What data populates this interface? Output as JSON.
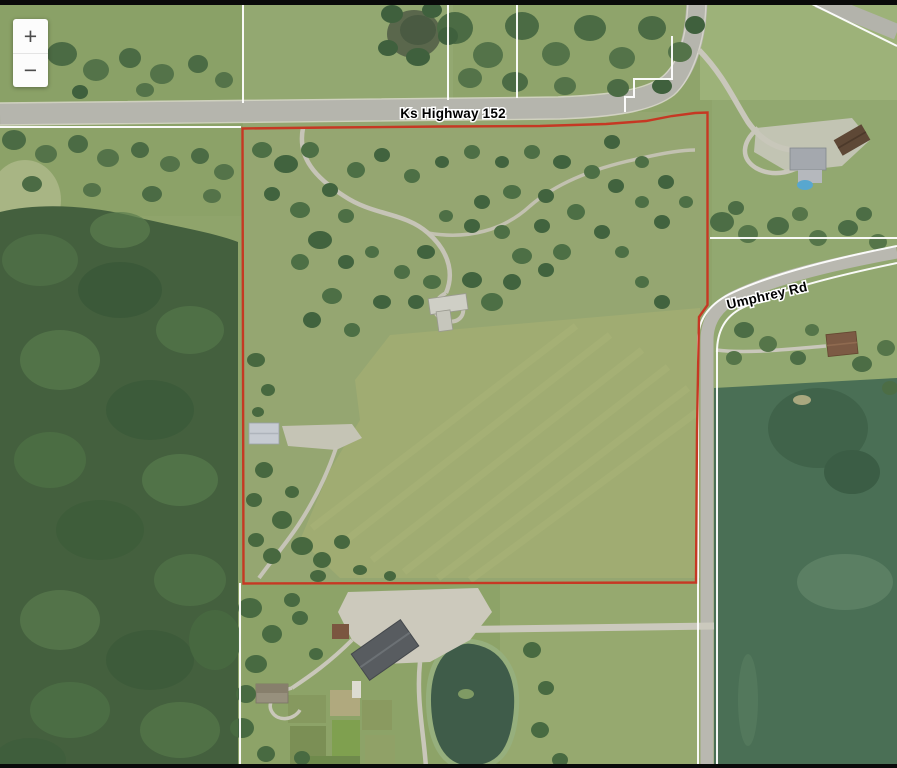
{
  "map_labels": {
    "highway": "Ks Highway 152",
    "road": "Umphrey Rd"
  },
  "zoom_control": {
    "zoom_in_label": "+",
    "zoom_out_label": "−"
  },
  "colors": {
    "boundary": "#c63823",
    "parcel_line": "#ffffff",
    "road": "#b7b6ae",
    "field": "#8fa46b",
    "forest": "#44603e",
    "crop_field": "#4a6f55",
    "water": "#3d5a49",
    "label_fill": "#000000",
    "label_halo": "#ffffff"
  }
}
